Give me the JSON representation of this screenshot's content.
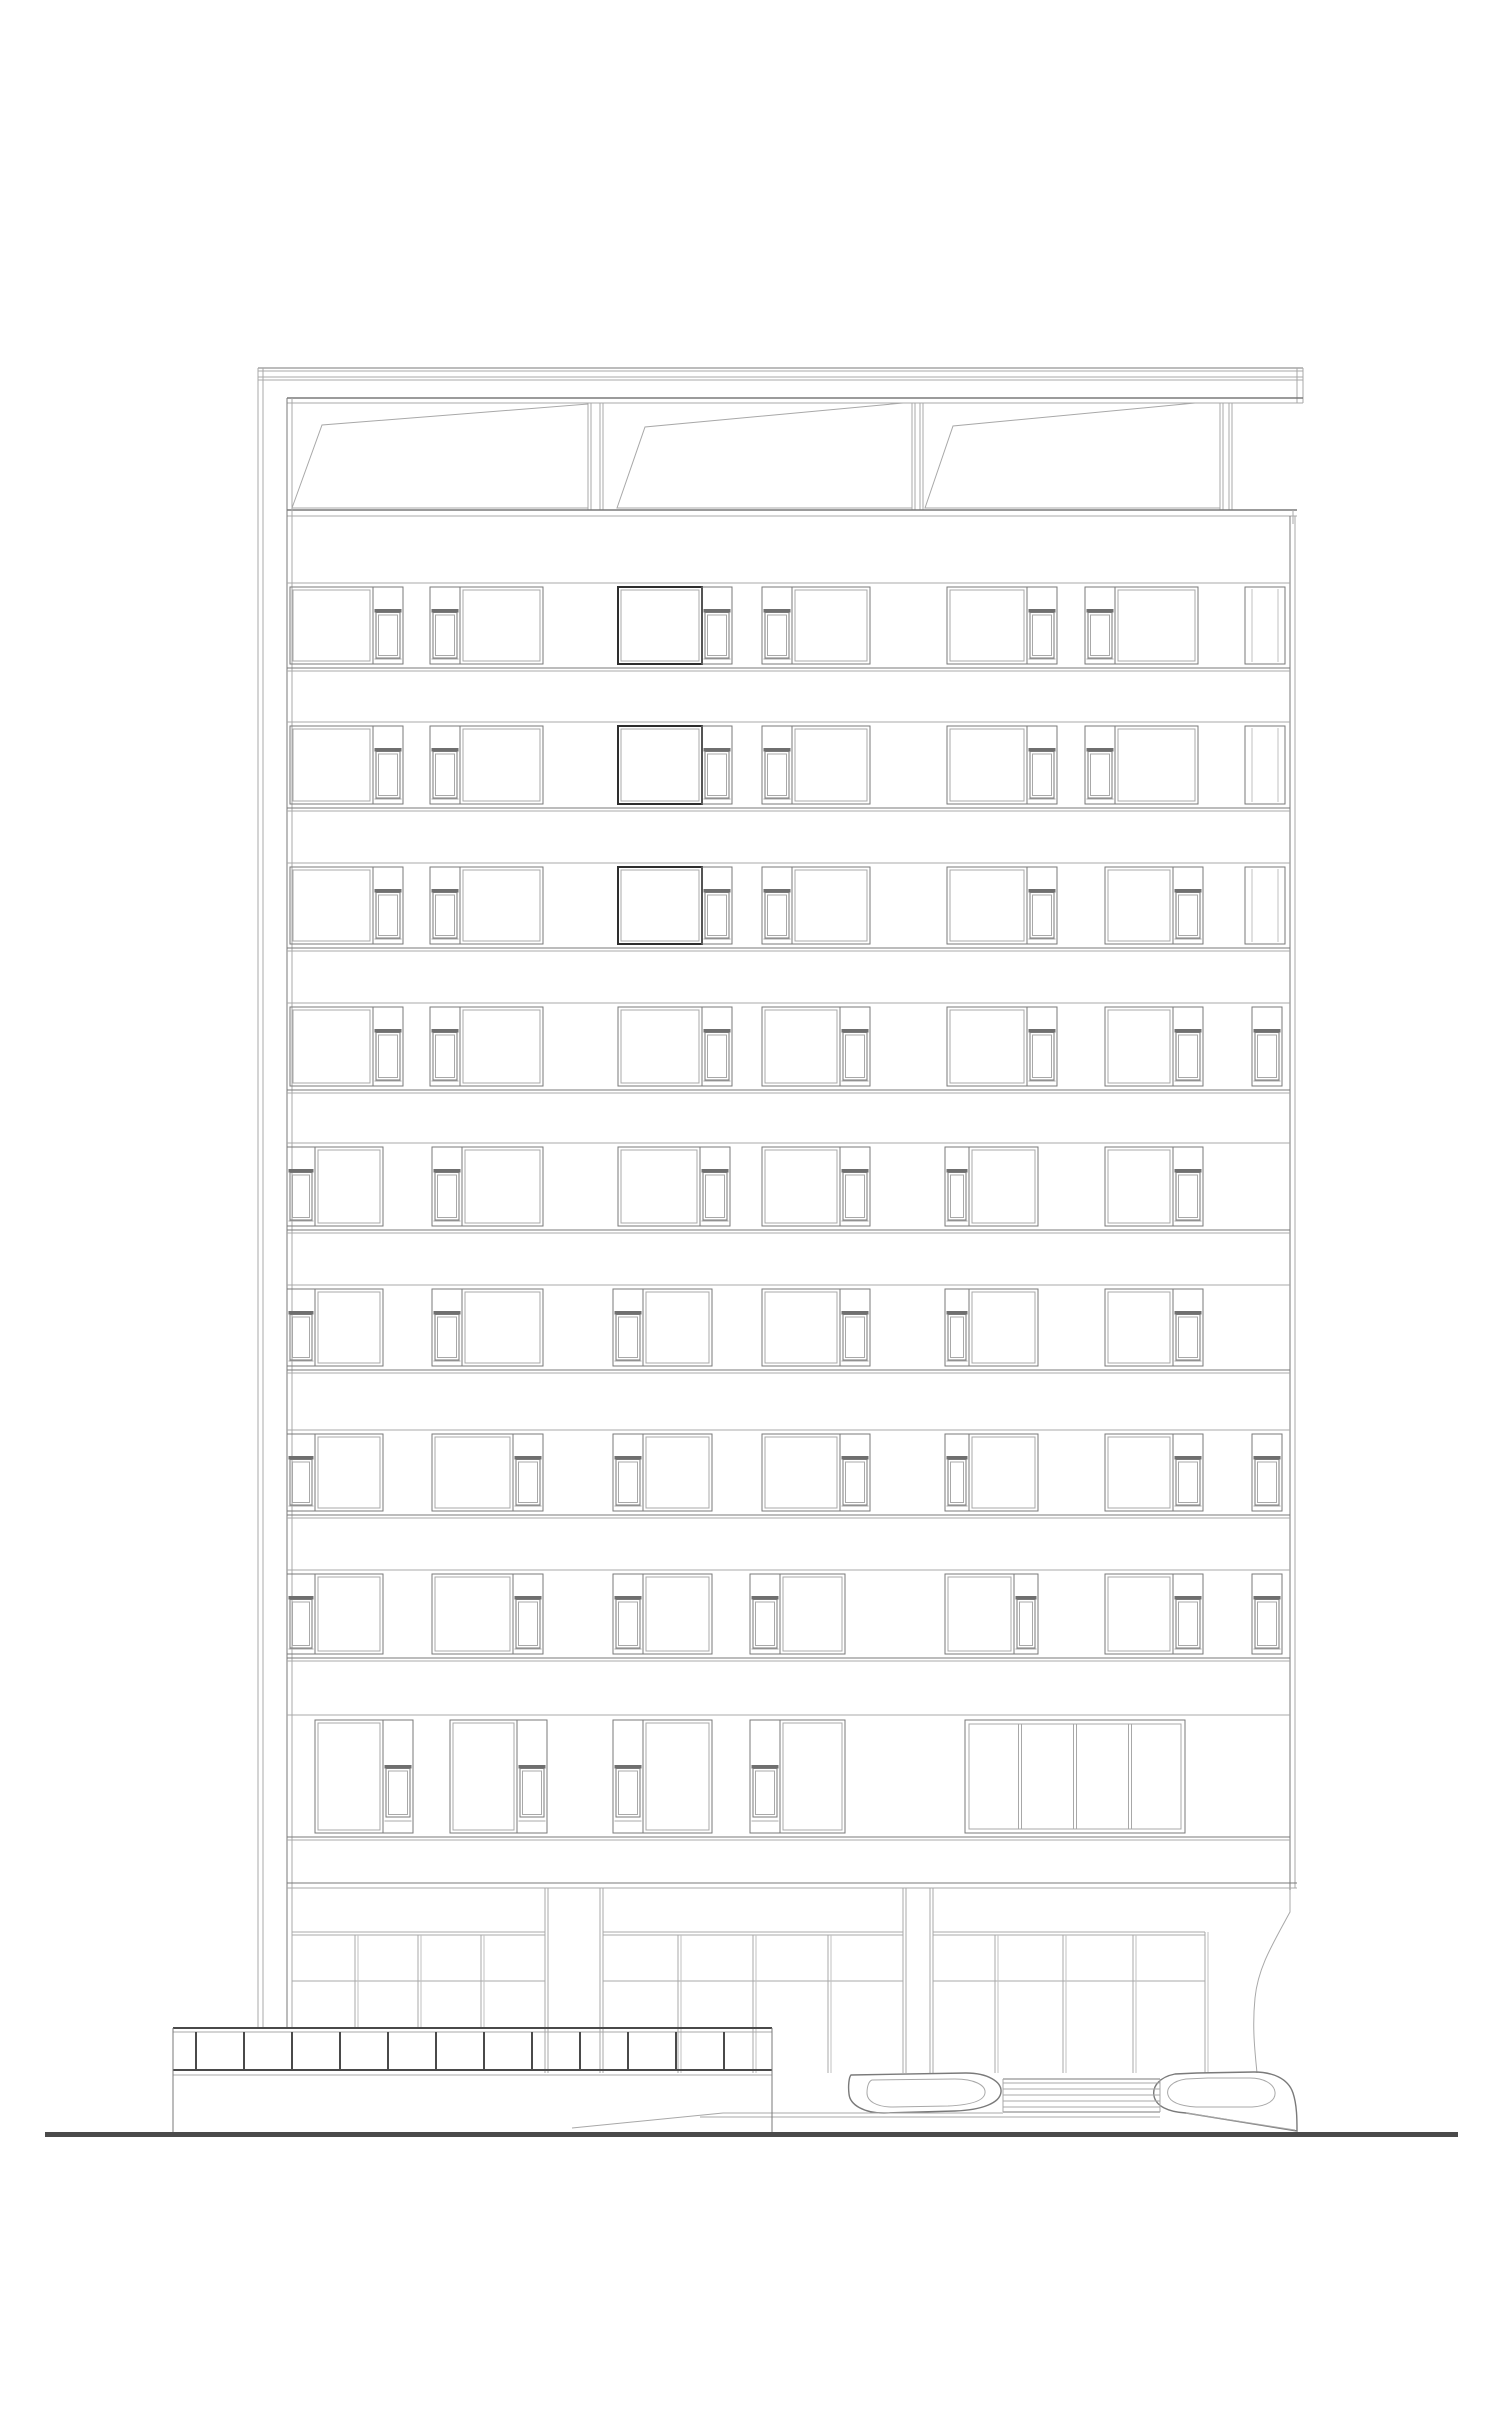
{
  "page": {
    "background": "#ffffff",
    "width": 1500,
    "height": 2423
  },
  "colors": {
    "line_light": "#a8a8a8",
    "line_mid": "#7a7a7a",
    "line_dark": "#4a4a4a",
    "line_heavy": "#2e2e2e",
    "sill_fill": "#6f6f6f",
    "ground_fill": "#4a4a4a"
  },
  "structure": {
    "outer_left_wall": {
      "x1": 258,
      "x2": 263,
      "y_top": 368,
      "y_bottom": 2028
    },
    "roof_slab": {
      "x1": 258,
      "x2": 1303,
      "lines": [
        368,
        371,
        377,
        380
      ],
      "cap_x1": 1297,
      "cap_x2": 1303,
      "cap_y1": 368,
      "cap_y2": 403
    },
    "pergola": {
      "header": {
        "y1": 398,
        "y2": 403,
        "x1": 287,
        "x2": 1303
      },
      "rail": {
        "y1": 510,
        "y2": 516,
        "x1": 287,
        "x2": 1297,
        "cap_x": 1293
      },
      "posts": [
        {
          "x1": 588,
          "x2": 603
        },
        {
          "x1": 912,
          "x2": 923
        },
        {
          "x1": 1220,
          "x2": 1232
        }
      ],
      "sails": [
        {
          "pts": [
            [
              292,
              508
            ],
            [
              322,
              425
            ],
            [
              588,
              404
            ],
            [
              588,
              508
            ]
          ]
        },
        {
          "pts": [
            [
              617,
              508
            ],
            [
              645,
              427
            ],
            [
              903,
              403
            ],
            [
              912,
              403
            ],
            [
              912,
              508
            ]
          ]
        },
        {
          "pts": [
            [
              925,
              508
            ],
            [
              953,
              426
            ],
            [
              1195,
              403
            ],
            [
              1220,
              403
            ],
            [
              1220,
              508
            ]
          ]
        }
      ]
    },
    "facade": {
      "x1": 287,
      "x1b": 292,
      "x2": 1290,
      "x2b": 1295,
      "top_y": 398,
      "fascia_y1": 516,
      "fascia_y2": 583,
      "left_bottom": 2028,
      "right_bottom": 1912
    },
    "floors": [
      {
        "y": 583,
        "h": 85,
        "windows": [
          {
            "type": "pair",
            "x": 290,
            "w": 113,
            "strip": "right"
          },
          {
            "type": "pair",
            "x": 430,
            "w": 113,
            "strip": "left"
          },
          {
            "type": "pair",
            "x": 618,
            "w": 114,
            "strip": "right",
            "dark": true
          },
          {
            "type": "pair",
            "x": 762,
            "w": 108,
            "strip": "left"
          },
          {
            "type": "pair",
            "x": 947,
            "w": 110,
            "strip": "right"
          },
          {
            "type": "pair",
            "x": 1085,
            "w": 113,
            "strip": "left"
          },
          {
            "type": "narrow",
            "x": 1245,
            "w": 40
          }
        ]
      },
      {
        "y": 722,
        "h": 86,
        "windows": [
          {
            "type": "pair",
            "x": 290,
            "w": 113,
            "strip": "right"
          },
          {
            "type": "pair",
            "x": 430,
            "w": 113,
            "strip": "left"
          },
          {
            "type": "pair",
            "x": 618,
            "w": 114,
            "strip": "right",
            "dark": true
          },
          {
            "type": "pair",
            "x": 762,
            "w": 108,
            "strip": "left"
          },
          {
            "type": "pair",
            "x": 947,
            "w": 110,
            "strip": "right"
          },
          {
            "type": "pair",
            "x": 1085,
            "w": 113,
            "strip": "left"
          },
          {
            "type": "narrow",
            "x": 1245,
            "w": 40
          }
        ]
      },
      {
        "y": 863,
        "h": 85,
        "windows": [
          {
            "type": "pair",
            "x": 290,
            "w": 113,
            "strip": "right"
          },
          {
            "type": "pair",
            "x": 430,
            "w": 113,
            "strip": "left"
          },
          {
            "type": "pair",
            "x": 618,
            "w": 114,
            "strip": "right",
            "dark": true
          },
          {
            "type": "pair",
            "x": 762,
            "w": 108,
            "strip": "left"
          },
          {
            "type": "pair",
            "x": 947,
            "w": 110,
            "strip": "right"
          },
          {
            "type": "pair",
            "x": 1105,
            "w": 98,
            "strip": "right"
          },
          {
            "type": "narrow",
            "x": 1245,
            "w": 40
          }
        ]
      },
      {
        "y": 1003,
        "h": 87,
        "windows": [
          {
            "type": "pair",
            "x": 290,
            "w": 113,
            "strip": "right"
          },
          {
            "type": "pair",
            "x": 430,
            "w": 113,
            "strip": "left"
          },
          {
            "type": "pair",
            "x": 618,
            "w": 114,
            "strip": "right"
          },
          {
            "type": "pair",
            "x": 762,
            "w": 108,
            "strip": "right"
          },
          {
            "type": "pair",
            "x": 947,
            "w": 110,
            "strip": "right"
          },
          {
            "type": "pair",
            "x": 1105,
            "w": 98,
            "strip": "right"
          },
          {
            "type": "strip",
            "x": 1252,
            "w": 30
          }
        ]
      },
      {
        "y": 1143,
        "h": 87,
        "windows": [
          {
            "type": "pair",
            "x": 287,
            "w": 96,
            "strip": "left",
            "sw": 28
          },
          {
            "type": "pair",
            "x": 432,
            "w": 111,
            "strip": "left"
          },
          {
            "type": "pair",
            "x": 618,
            "w": 112,
            "strip": "right"
          },
          {
            "type": "pair",
            "x": 762,
            "w": 108,
            "strip": "right"
          },
          {
            "type": "pair",
            "x": 945,
            "w": 93,
            "strip": "left",
            "sw": 24
          },
          {
            "type": "pair",
            "x": 1105,
            "w": 98,
            "strip": "right"
          }
        ]
      },
      {
        "y": 1285,
        "h": 85,
        "windows": [
          {
            "type": "pair",
            "x": 287,
            "w": 96,
            "strip": "left",
            "sw": 28
          },
          {
            "type": "pair",
            "x": 432,
            "w": 111,
            "strip": "left"
          },
          {
            "type": "pair",
            "x": 613,
            "w": 99,
            "strip": "left"
          },
          {
            "type": "pair",
            "x": 762,
            "w": 108,
            "strip": "right"
          },
          {
            "type": "pair",
            "x": 945,
            "w": 93,
            "strip": "left",
            "sw": 24
          },
          {
            "type": "pair",
            "x": 1105,
            "w": 98,
            "strip": "right"
          }
        ]
      },
      {
        "y": 1430,
        "h": 85,
        "windows": [
          {
            "type": "pair",
            "x": 287,
            "w": 96,
            "strip": "left",
            "sw": 28
          },
          {
            "type": "pair",
            "x": 432,
            "w": 111,
            "strip": "right"
          },
          {
            "type": "pair",
            "x": 613,
            "w": 99,
            "strip": "left"
          },
          {
            "type": "pair",
            "x": 762,
            "w": 108,
            "strip": "right"
          },
          {
            "type": "pair",
            "x": 945,
            "w": 93,
            "strip": "left",
            "sw": 24
          },
          {
            "type": "pair",
            "x": 1105,
            "w": 98,
            "strip": "right"
          },
          {
            "type": "strip",
            "x": 1252,
            "w": 30
          }
        ]
      },
      {
        "y": 1570,
        "h": 88,
        "windows": [
          {
            "type": "pair",
            "x": 287,
            "w": 96,
            "strip": "left",
            "sw": 28
          },
          {
            "type": "pair",
            "x": 432,
            "w": 111,
            "strip": "right"
          },
          {
            "type": "pair",
            "x": 613,
            "w": 99,
            "strip": "left"
          },
          {
            "type": "pair",
            "x": 750,
            "w": 95,
            "strip": "left"
          },
          {
            "type": "pair",
            "x": 945,
            "w": 93,
            "strip": "right",
            "sw": 24
          },
          {
            "type": "pair",
            "x": 1105,
            "w": 98,
            "strip": "right"
          },
          {
            "type": "strip",
            "x": 1252,
            "w": 30
          }
        ]
      },
      {
        "y": 1715,
        "h": 122,
        "tall": true,
        "windows": [
          {
            "type": "pair",
            "x": 315,
            "w": 98,
            "strip": "right"
          },
          {
            "type": "pair",
            "x": 450,
            "w": 97,
            "strip": "right"
          },
          {
            "type": "pair",
            "x": 613,
            "w": 99,
            "strip": "left"
          },
          {
            "type": "pair",
            "x": 750,
            "w": 95,
            "strip": "left"
          },
          {
            "type": "wide4",
            "x": 965,
            "w": 220
          }
        ]
      }
    ],
    "ground_floor": {
      "lintel_y": 1883,
      "x1": 287,
      "x2": 1297,
      "piers": [
        {
          "x": 545,
          "w": 58
        },
        {
          "x": 903,
          "w": 30
        }
      ],
      "pier_top": 1888,
      "pier_bottom": 2073,
      "transom_y": 1932,
      "mid_y": 1981,
      "bays": [
        {
          "x1": 292,
          "x2": 545,
          "mullions": [
            355,
            418,
            481
          ],
          "mullion_bottom": 2028
        },
        {
          "x1": 603,
          "x2": 903,
          "mullions": [
            678,
            753,
            828
          ],
          "mullion_bottom": 2073
        },
        {
          "x1": 933,
          "x2": 1205,
          "mullions": [
            995,
            1063,
            1133
          ],
          "mullion_bottom": 2073
        }
      ],
      "end_frame": {
        "x1": 1205,
        "x2": 1208,
        "y1": 1932,
        "y2": 2073
      },
      "right_curve": "M1290,1890 L1290,1912 C1272,1945 1258,1968 1255,1998 C1252,2028 1255,2052 1257,2073"
    },
    "entrance": {
      "steps": {
        "x1": 1003,
        "x2": 1160,
        "top_y": 2079,
        "treads": [
          2083,
          2089,
          2095,
          2101,
          2107
        ],
        "base_y": 2112,
        "base_y2": 2117
      },
      "left_pod": {
        "outer": "M851,2075 L966,2073 C988,2073 1002,2082 1001,2092 C1000,2103 982,2110 955,2111 L884,2113 C864,2113 850,2105 849,2094 C848,2086 849,2077 851,2075 Z",
        "inner": "M872,2080 L955,2079 C974,2079 986,2085 985,2093 C984,2101 970,2105 948,2106 L893,2107 C876,2107 867,2101 867,2093 C867,2086 869,2081 872,2080 Z"
      },
      "right_pod": {
        "outer": "M1197,2073 L1175,2074 C1160,2077 1152,2086 1154,2096 C1156,2106 1168,2112 1186,2113 L1297,2131 C1297,2120 1297,2105 1293,2093 C1288,2078 1272,2072 1254,2072 Z",
        "inner": "M1208,2078 L1186,2079 C1172,2081 1166,2088 1168,2095 C1170,2102 1180,2106 1196,2107 L1252,2107 C1268,2106 1276,2100 1275,2092 C1274,2084 1264,2078 1250,2078 Z",
        "accent": "M1186,2113 L1295,2130"
      },
      "walkway": {
        "ramp": [
          [
            572,
            2128
          ],
          [
            723,
            2113
          ]
        ],
        "lines": [
          {
            "y": 2113,
            "x1": 723,
            "x2": 1003
          },
          {
            "y": 2117,
            "x1": 700,
            "x2": 1003
          }
        ]
      }
    },
    "planter_wall": {
      "x1": 173,
      "x2": 772,
      "top_y": 2028,
      "band_y1": 2032,
      "band_y2": 2070,
      "coping_y": 2075,
      "bottom_y": 2133,
      "verticals": [
        196,
        244,
        292,
        340,
        388,
        436,
        484,
        532,
        580,
        628,
        676,
        724
      ]
    },
    "ground_line": {
      "x1": 45,
      "x2": 1458,
      "y": 2132,
      "h": 5
    }
  }
}
